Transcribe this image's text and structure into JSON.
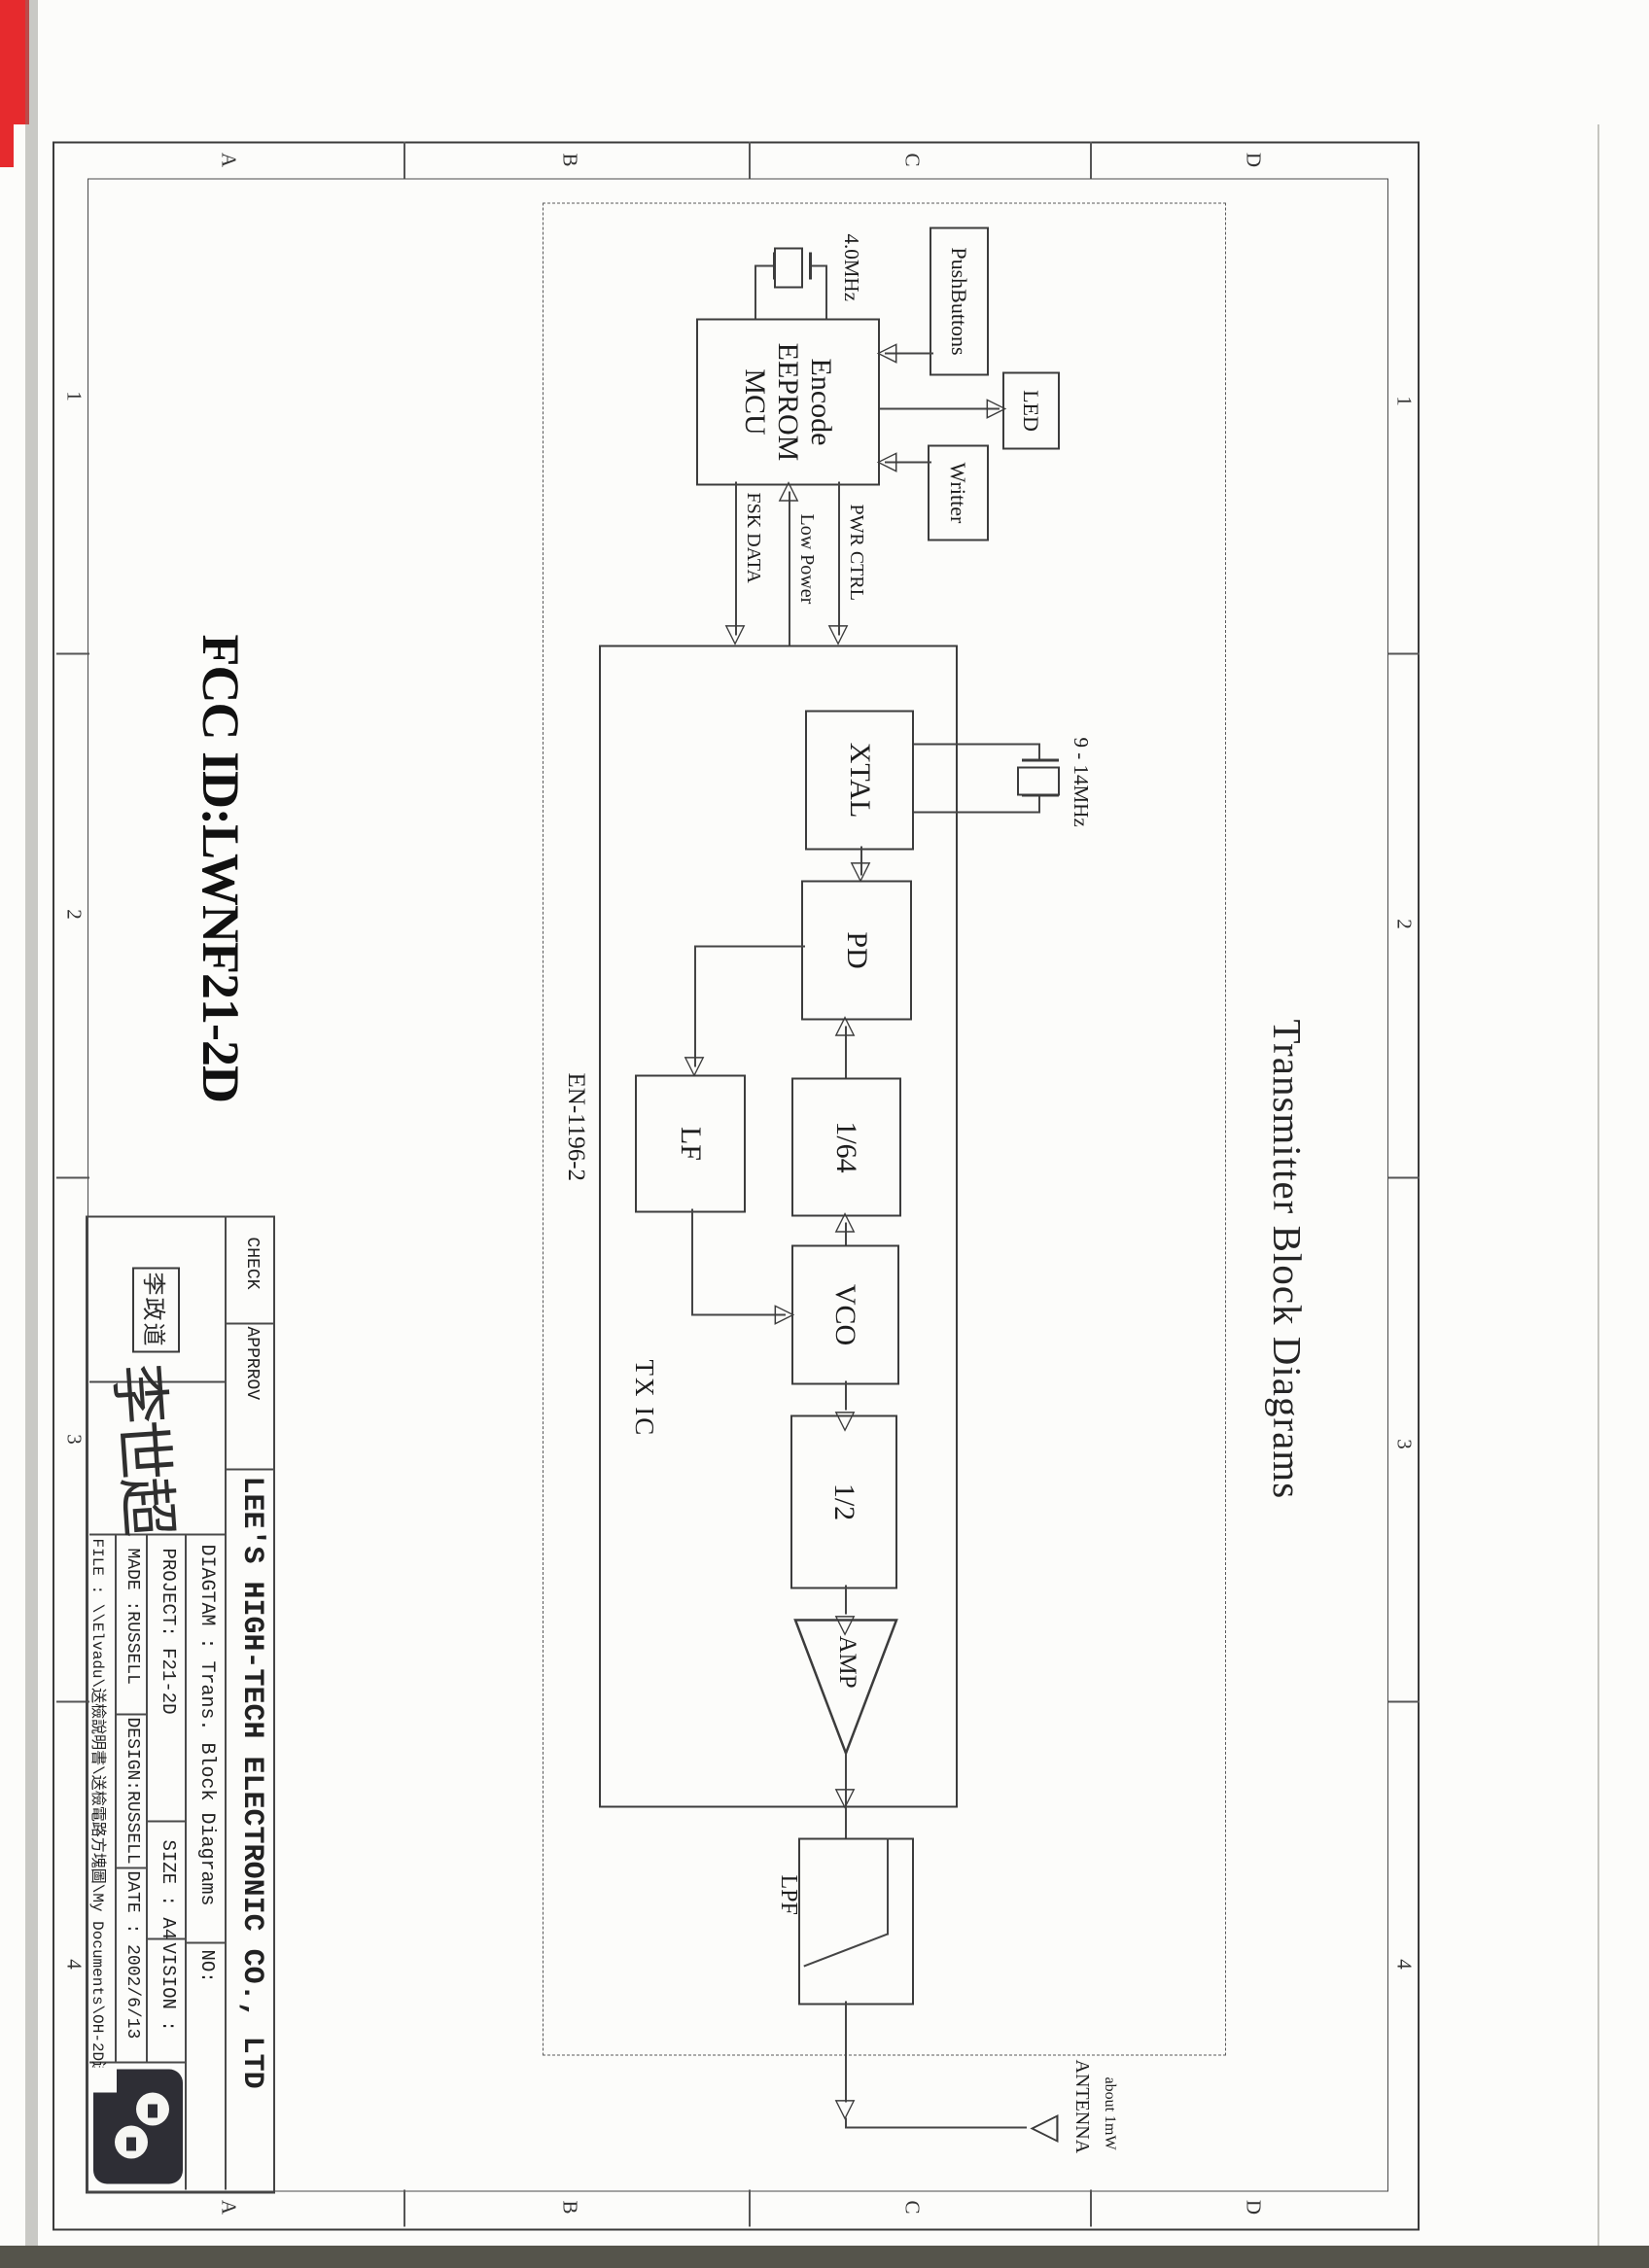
{
  "page": {
    "fcc_id": "FCC ID:LWNF21-2D",
    "title": "Transmitter Block Diagrams"
  },
  "border": {
    "letters": [
      "A",
      "B",
      "C",
      "D"
    ],
    "numbers": [
      "1",
      "2",
      "3",
      "4"
    ]
  },
  "icons": {
    "tri_right": "▷",
    "tri_left": "◁",
    "tri_up": "△",
    "tri_down": "▽",
    "antenna_triangle": "▽"
  },
  "diagram": {
    "mcu": {
      "line1": "Encode",
      "line2": "EEPROM",
      "line3": "MCU"
    },
    "peripherals": {
      "pushbuttons": "PushButtons",
      "led": "LED",
      "writer": "Writter"
    },
    "mcu_crystal": "4.0MHz",
    "signals": {
      "fsk": "FSK  DATA",
      "low_power": "Low Power",
      "pwr_ctrl": "PWR CTRL"
    },
    "tx_ic": {
      "label": "TX IC",
      "part_no": "EN-1196-2",
      "blocks": {
        "xtal": "XTAL",
        "pd": "PD",
        "div64": "1/64",
        "lf": "LF",
        "vco": "VCO",
        "div2": "1/2",
        "amp": "AMP",
        "lpf": "LPF"
      }
    },
    "ref_crystal": "9 - 14MHz",
    "antenna": {
      "label": "ANTENNA",
      "power": "about 1mW"
    }
  },
  "title_block": {
    "company": "LEE'S HIGH-TECH ELECTRONIC CO., LTD",
    "check_label": "CHECK",
    "approv_label": "APPRROV",
    "check_stamp": "李政道",
    "approv_signature": "李世超",
    "diagram_label": "DIAGTAM : Trans. Block Diagrams",
    "no_label": "NO:",
    "project": "PROJECT:  F21-2D",
    "size": "SIZE : A4",
    "vision": "VISION :",
    "made": "MADE :RUSSELL",
    "design": "DESIGN:RUSSELL",
    "date": "DATE :  2002/6/13",
    "file": "FILE : \\\\Elvadu\\送檢說明書\\送檢電路方塊圖\\My Documents\\OH-2D送檢"
  }
}
